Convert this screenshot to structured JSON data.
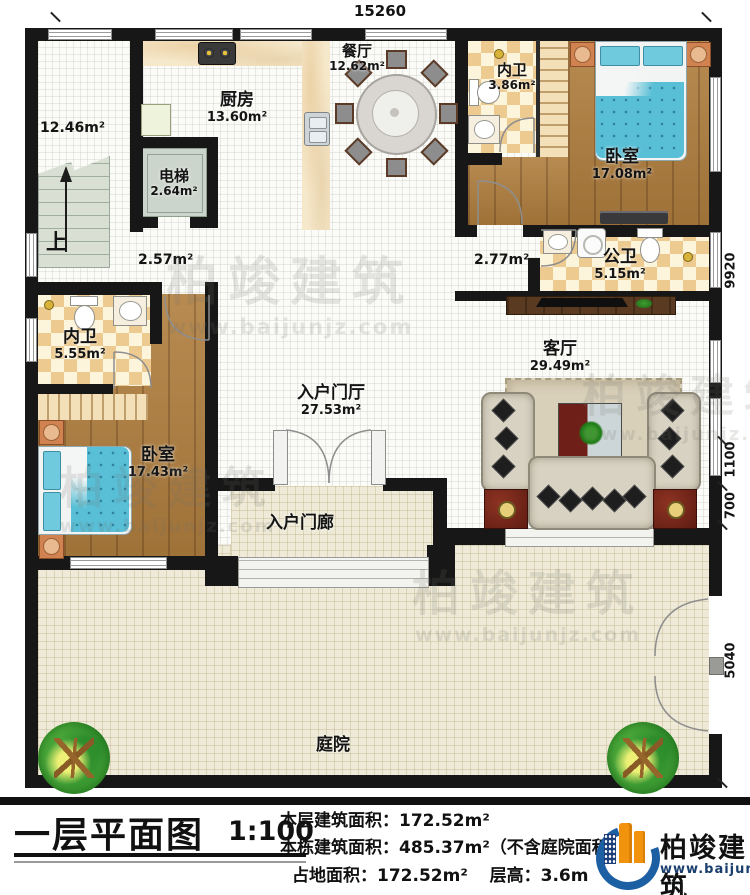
{
  "plan": {
    "dimensions": {
      "top": "15260",
      "right": [
        "9920",
        "1100",
        "700",
        "5040"
      ]
    },
    "rooms": {
      "kitchen": {
        "name": "厨房",
        "area": "13.60m²"
      },
      "dining": {
        "name": "餐厅",
        "area": "12.62m²"
      },
      "bath_top": {
        "name": "内卫",
        "area": "3.86m²"
      },
      "bedroom_top": {
        "name": "卧室",
        "area": "17.08m²"
      },
      "elevator": {
        "name": "电梯",
        "area": "2.64m²"
      },
      "public_bath": {
        "name": "公卫",
        "area": "5.15m²"
      },
      "bath_left": {
        "name": "内卫",
        "area": "5.55m²"
      },
      "bedroom_left": {
        "name": "卧室",
        "area": "17.43m²"
      },
      "entry_hall": {
        "name": "入户门厅",
        "area": "27.53m²"
      },
      "living": {
        "name": "客厅",
        "area": "29.49m²"
      },
      "porch": {
        "name": "入户门廊"
      },
      "courtyard": {
        "name": "庭院"
      }
    },
    "annotations": {
      "stair_area": "12.46m²",
      "stairs_up": "上",
      "hall_area_left": "2.57m²",
      "hall_area_right": "2.77m²"
    }
  },
  "watermark": {
    "brand": "柏竣建筑",
    "url": "www.baijunjz.com"
  },
  "title_block": {
    "title": "一层平面图",
    "scale": "1:100",
    "floor_area_label": "本层建筑面积：",
    "floor_area_value": "172.52m²",
    "building_area_label": "本栋建筑面积：",
    "building_area_value": "485.37m²（不含庭院面积）",
    "land_area_label": "占地面积：",
    "land_area_value": "172.52m²",
    "height_label": "层高：",
    "height_value": "3.6m"
  },
  "logo": {
    "brand": "柏竣建筑",
    "url": "www.baijunjz.com"
  }
}
